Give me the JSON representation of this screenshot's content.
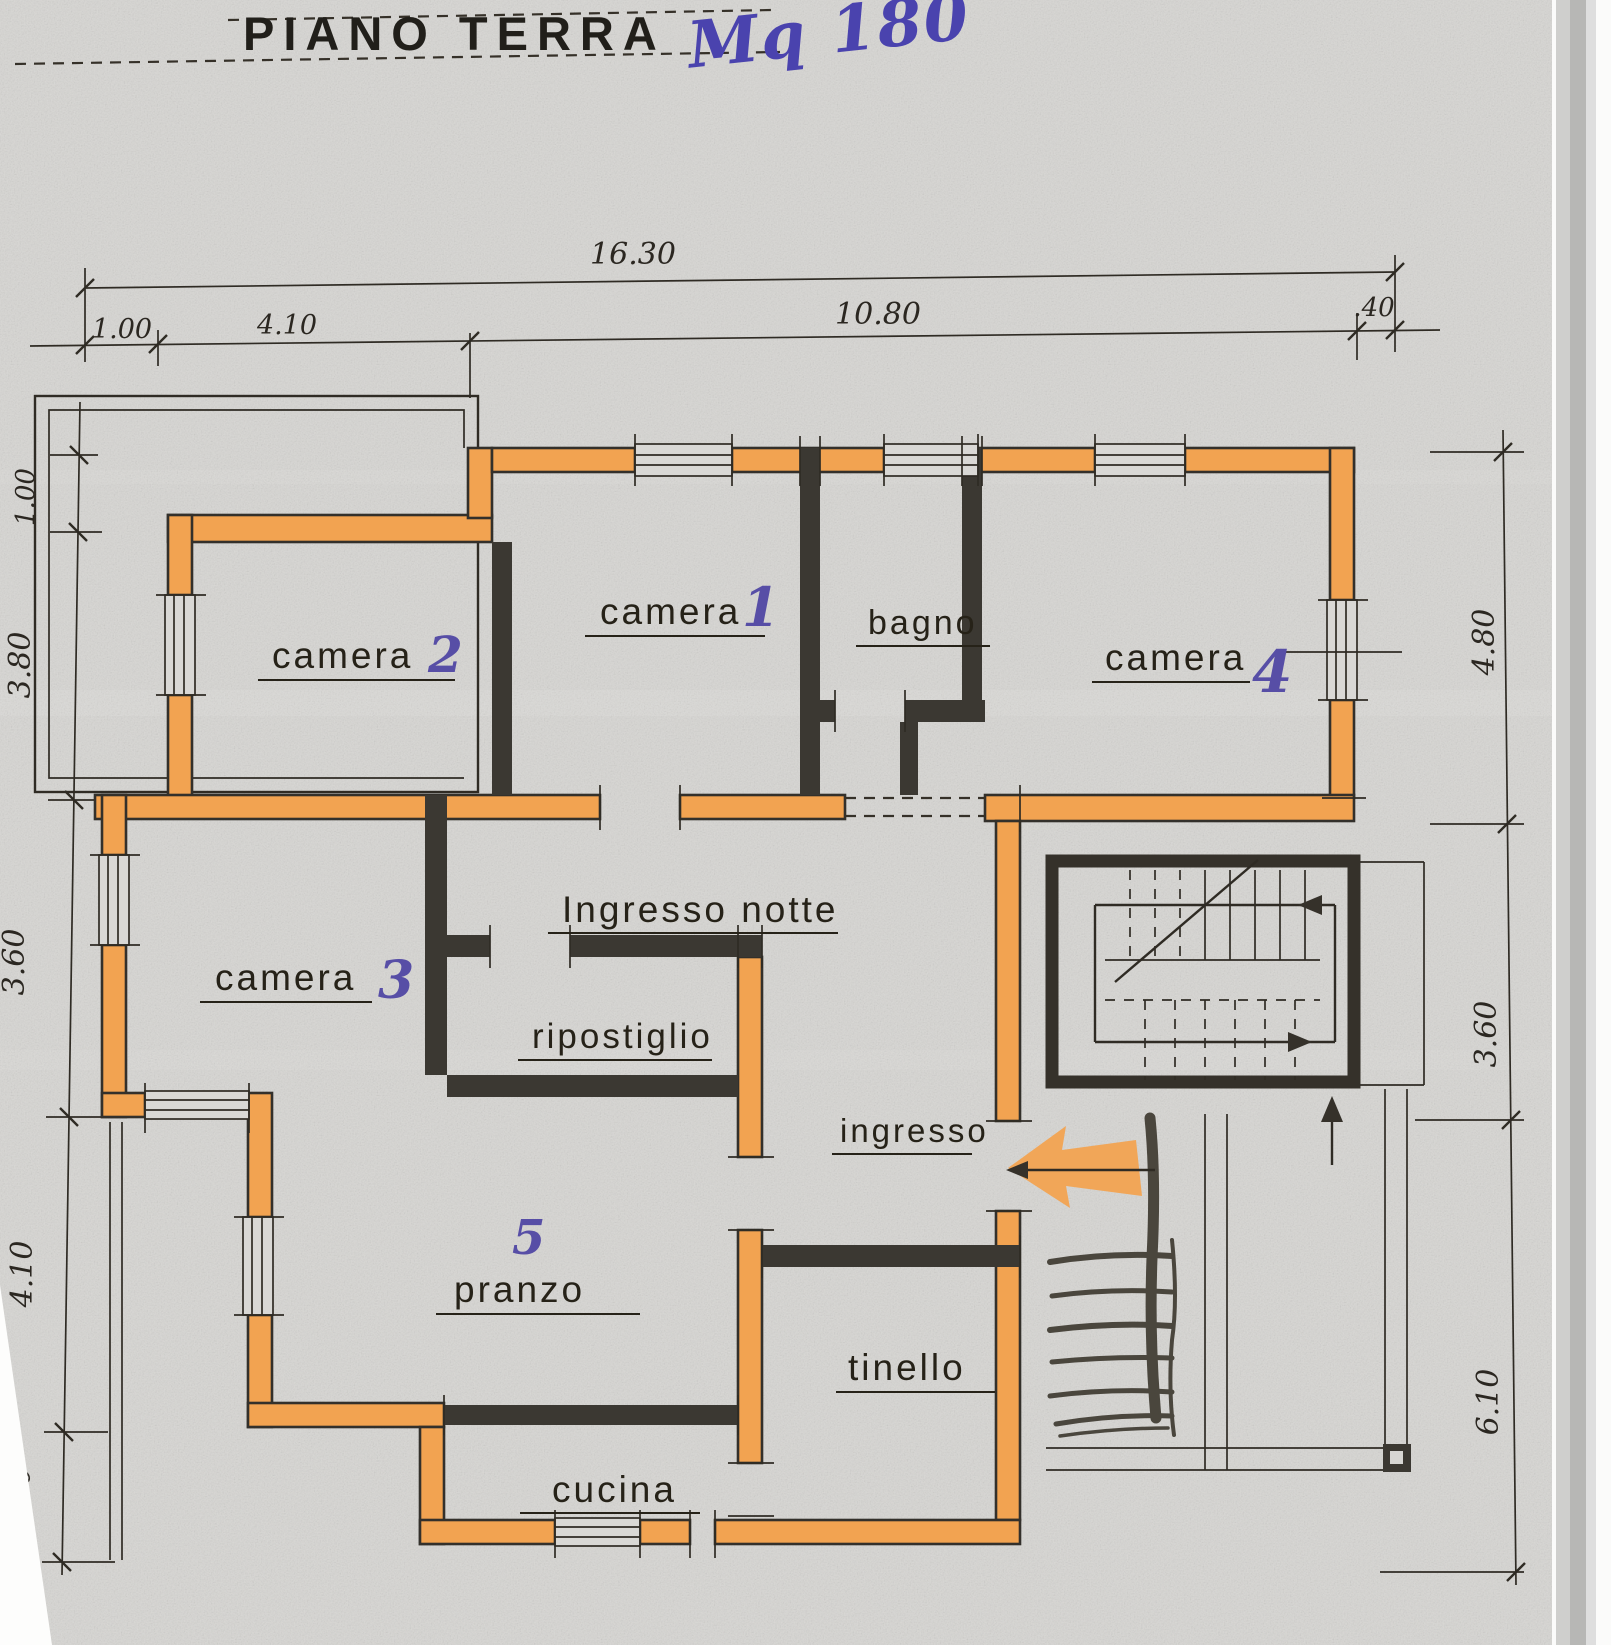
{
  "title": "PIANO TERRA",
  "annotation": "Mq 180",
  "rooms": {
    "camera1": {
      "label": "camera",
      "number": "1"
    },
    "camera2": {
      "label": "camera",
      "number": "2"
    },
    "camera3": {
      "label": "camera",
      "number": "3"
    },
    "camera4": {
      "label": "camera",
      "number": "4"
    },
    "bagno": {
      "label": "bagno"
    },
    "ingresso_notte": {
      "label": "Ingresso notte"
    },
    "ripostiglio": {
      "label": "ripostiglio"
    },
    "ingresso": {
      "label": "ingresso"
    },
    "pranzo": {
      "label": "pranzo",
      "number": "5"
    },
    "tinello": {
      "label": "tinello"
    },
    "cucina": {
      "label": "cucina"
    }
  },
  "dimensions": {
    "top_total": "16.30",
    "top_segments": [
      "1.00",
      "4.10",
      "10.80",
      ".40"
    ],
    "left": [
      "1.00",
      "3.80",
      "3.60",
      "4.10",
      "2.00"
    ],
    "right": [
      "4.80",
      "3.60",
      "6.10"
    ]
  },
  "colors": {
    "wall_highlight": "#f2a351",
    "ink": "#2f2b24",
    "number_ink": "#574ea6",
    "annotation_ink": "#4a43ae",
    "paper": "#d7d6d3"
  }
}
